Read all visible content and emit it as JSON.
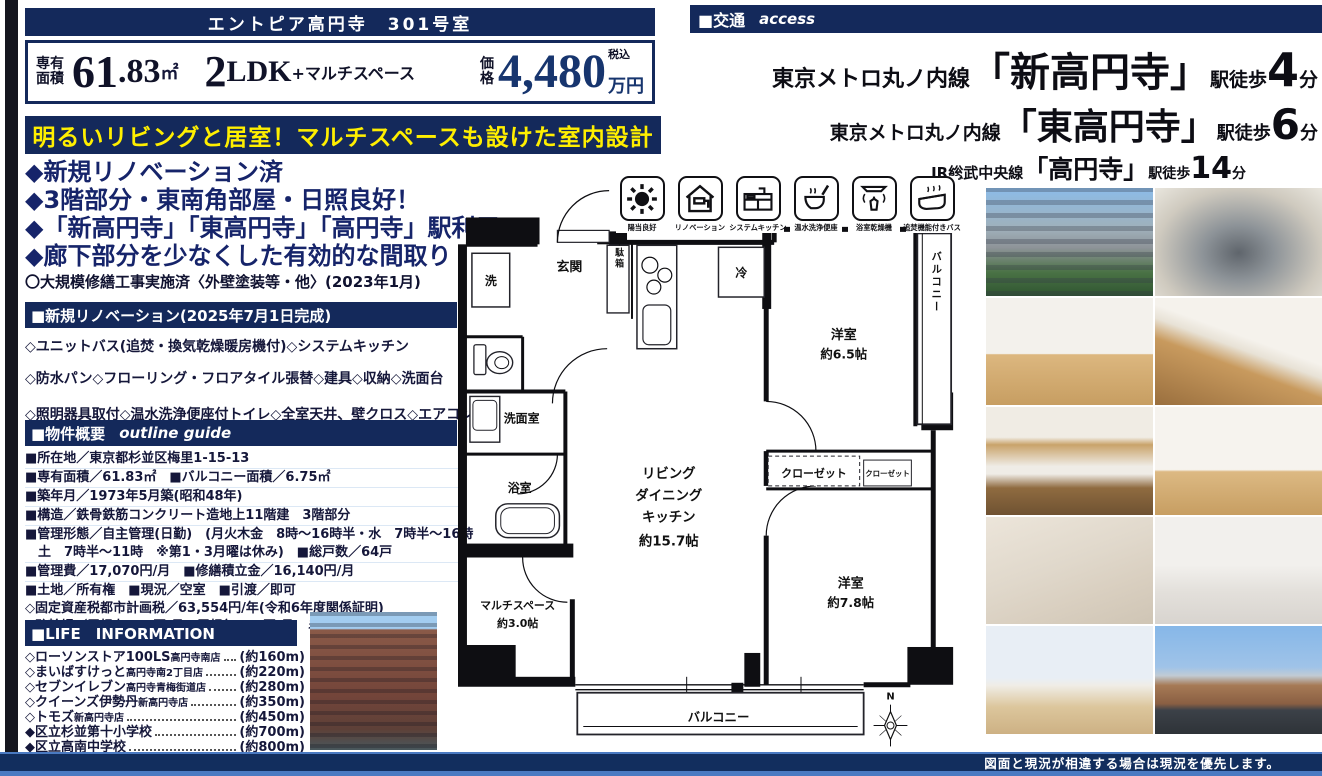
{
  "colors": {
    "navy": "#14295b",
    "banner_yellow": "#ffef00",
    "footer_light_blue": "#4a7ac2"
  },
  "title_bar": {
    "text": "エントピア高円寺　301号室"
  },
  "price_box": {
    "area_label_1": "専有",
    "area_label_2": "面積",
    "area_int": "61",
    "area_dec": ".83",
    "area_unit": "㎡",
    "plan_num": "2",
    "plan_type": "LDK",
    "plan_plus": "+マルチスペース",
    "price_label_1": "価",
    "price_label_2": "格",
    "price_tax": "税込",
    "price_value": "4,480",
    "price_unit": "万円"
  },
  "catch_banner": {
    "text": "明るいリビングと居室！マルチスペースも設けた室内設計"
  },
  "highlights": {
    "items": [
      "◆新規リノベーション済",
      "◆3階部分・東南角部屋・日照良好！",
      "◆「新高円寺」「東高円寺」「高円寺」駅利用",
      "◆廊下部分を少なくした有効的な間取り"
    ],
    "note": "〇大規模修繕工事実施済〈外壁塗装等・他〉(2023年1月)"
  },
  "renovation": {
    "header": "■新規リノベーション(2025年7月1日完成)",
    "items": [
      "◇ユニットバス(追焚・換気乾燥暖房機付)◇システムキッチン",
      "◇防水パン◇フローリング・フロアタイル張替◇建具◇収納◇洗面台",
      "◇照明器具取付◇温水洗浄便座付トイレ◇全室天井、壁クロス◇エアコン",
      "◇給水給湯管(専有部分)◇クリーニング・他"
    ]
  },
  "outline": {
    "header": "■物件概要",
    "header_en": "outline guide",
    "rows": [
      "■所在地／東京都杉並区梅里1-15-13",
      "■専有面積／61.83㎡　■バルコニー面積／6.75㎡",
      "■築年月／1973年5月築(昭和48年)",
      "■構造／鉄骨鉄筋コンクリート造地上11階建　3階部分",
      "■管理形態／自主管理(日勤)　(月火木金　8時～16時半・水　7時半～16時",
      "　土　7時半～11時　※第1・3月曜は休み)　■総戸数／64戸",
      "■管理費／17,070円/月　■修繕積立金／16,140円/月",
      "■土地／所有権　■現況／空室　■引渡／即可",
      "◇固定資産税都市計画税／63,554円/年(令和6年度関係証明)",
      "◇駐輪場／屋根有600円/月　屋根無400円/月　ミニバイク700円/月"
    ]
  },
  "life_info": {
    "header": "■LIFE　INFORMATION",
    "items": [
      {
        "name": "◇ローソンストア100LS",
        "branch": "高円寺南店",
        "distance": "(約160m)"
      },
      {
        "name": "◇まいばすけっと",
        "branch": "高円寺南2丁目店",
        "distance": "(約220m)"
      },
      {
        "name": "◇セブンイレブン",
        "branch": "高円寺青梅街道店",
        "distance": "(約280m)"
      },
      {
        "name": "◇クイーンズ伊勢丹",
        "branch": "新高円寺店",
        "distance": "(約350m)"
      },
      {
        "name": "◇トモズ",
        "branch": "新高円寺店",
        "distance": "(約450m)"
      },
      {
        "name": "◆区立杉並第十小学校",
        "branch": "",
        "distance": "(約700m)"
      },
      {
        "name": "◆区立高南中学校",
        "branch": "",
        "distance": "(約800m)"
      }
    ]
  },
  "access": {
    "header": "■交通",
    "header_en": "access",
    "routes": [
      {
        "line": "東京メトロ丸ノ内線",
        "station": "「新高円寺」",
        "walk": "駅徒歩",
        "minutes": "4",
        "unit": "分"
      },
      {
        "line": "東京メトロ丸ノ内線",
        "station": "「東高円寺」",
        "walk": "駅徒歩",
        "minutes": "6",
        "unit": "分"
      },
      {
        "line": "JR総武中央線",
        "station": "「高円寺」",
        "walk": "駅徒歩",
        "minutes": "14",
        "unit": "分"
      }
    ]
  },
  "feature_icons": [
    {
      "label": "陽当良好"
    },
    {
      "label": "リノベーション"
    },
    {
      "label": "システムキッチン"
    },
    {
      "label": "温水洗浄便座"
    },
    {
      "label": "浴室乾燥機"
    },
    {
      "label": "追焚機能付きバス"
    }
  ],
  "floor_plan": {
    "entrance": "玄関",
    "shoe_box": "下駄箱",
    "washer": "洗",
    "fridge": "冷",
    "bedroom1_name": "洋室",
    "bedroom1_size": "約6.5帖",
    "balcony_side": "バルコニー",
    "washroom": "洗面室",
    "bathroom": "浴室",
    "ldk_1": "リビング",
    "ldk_2": "ダイニング",
    "ldk_3": "キッチン",
    "ldk_4": "約15.7帖",
    "closet_1": "クローゼット",
    "closet_2": "クローゼット",
    "bedroom2_name": "洋室",
    "bedroom2_size": "約7.8帖",
    "multi_name": "マルチスペース",
    "multi_size": "約3.0帖",
    "balcony_bottom": "バルコニー",
    "compass_n": "N"
  },
  "photos": {
    "grid": [
      "exterior-building",
      "entrance-approach",
      "living-room",
      "ldk-with-kitchen",
      "kitchen",
      "living-room-2",
      "unit-bath",
      "washbasin",
      "corner-room-windows",
      "balcony-view"
    ],
    "side": "building-street-view"
  },
  "footer": {
    "note": "図面と現況が相違する場合は現況を優先します。"
  }
}
